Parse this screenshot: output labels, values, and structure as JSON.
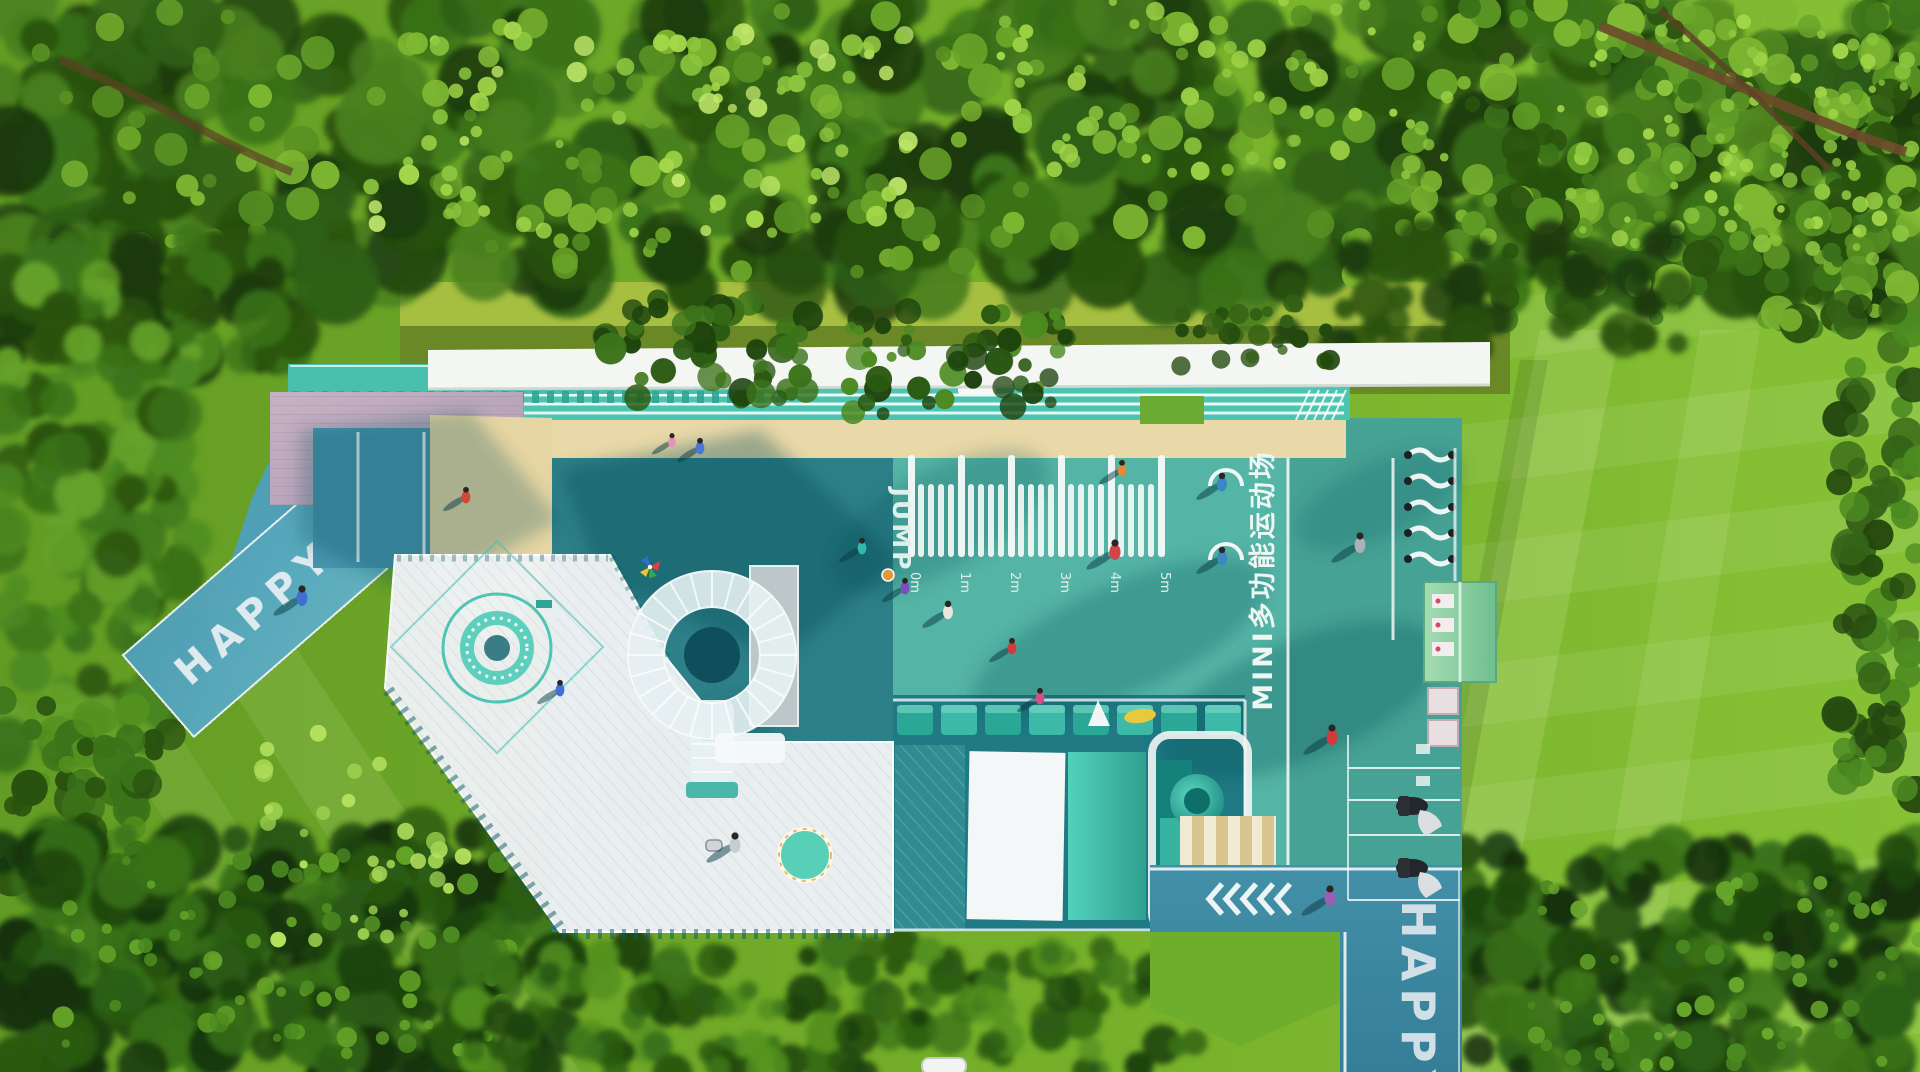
{
  "labels": {
    "entry_pad": "HAPPY",
    "exit_road": "HAPPY",
    "jump_ruler": "JUMP",
    "court_name": "MINI多功能运动场",
    "ruler_marks": [
      "0m",
      "1m",
      "2m",
      "3m",
      "4m",
      "5m"
    ]
  },
  "palette": {
    "tree_canopy": "#24470f",
    "lawn": "#7ab42c",
    "court_teal": "#54b4a5",
    "activity_zone_teal": "#2d7f88",
    "road_blue": "#4f9fb5",
    "sand": "#ead9a8",
    "deck_wood": "#c0aabc",
    "deck_white": "#edf1f2",
    "roof_white": "#f4f6f3",
    "train_teal": "#2fae9c",
    "kiosk_green": "#8fd0a5",
    "marking_white": "#ffffff"
  }
}
